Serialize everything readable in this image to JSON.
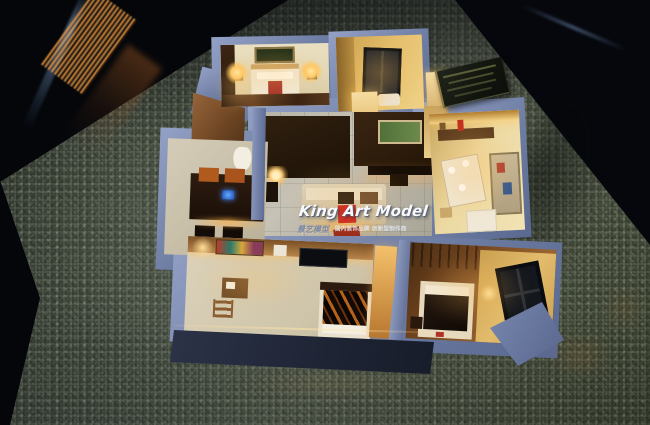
{
  "scene": {
    "caption": "Illuminated miniature apartment scale model displayed on green textured carpet inside a dark glass case"
  },
  "watermark": {
    "title": "King Art Model",
    "brand_cn": "景艺模型",
    "tagline_cn": "国内装饰品牌 创新型制作商"
  },
  "colors": {
    "accent_red": "#cf2b20",
    "title_white": "#f8f9fc",
    "brand_grey": "#7d8aa6",
    "tagline_light": "#dfe6f2",
    "wall_blue": "#7888ac",
    "wall_navy": "#232a3d",
    "carpet_green": "#454d43",
    "warm_glow": "#ffc46a"
  }
}
